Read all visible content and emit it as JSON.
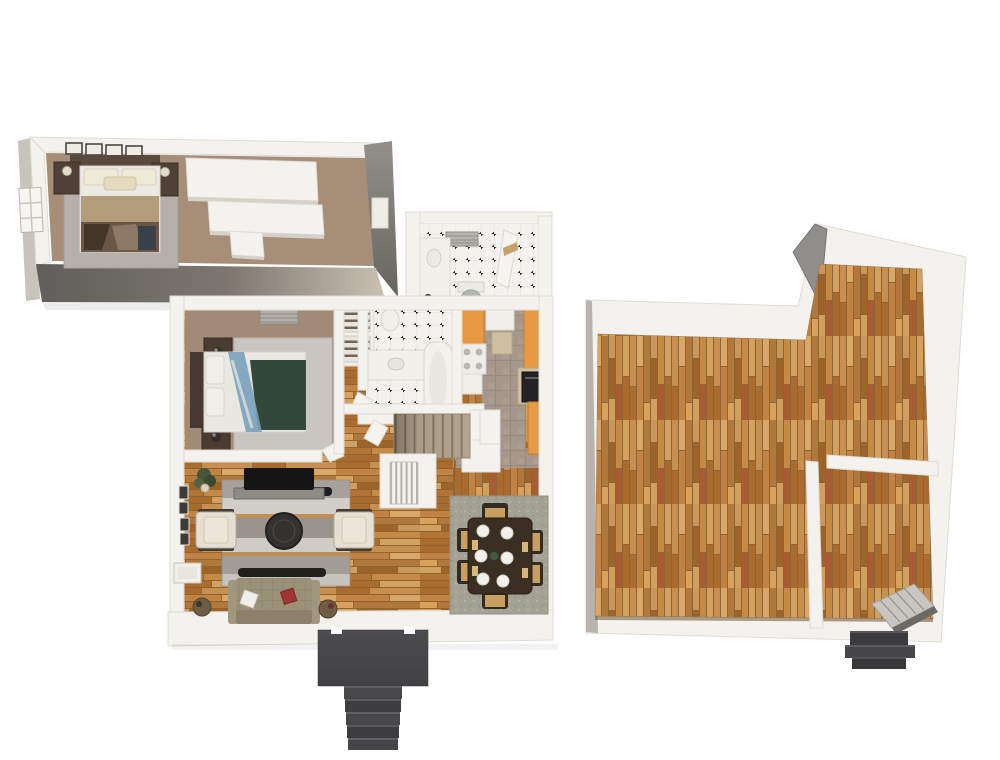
{
  "scene": {
    "type": "3d-floor-plan-render",
    "background": "#ffffff",
    "text_content": "none",
    "palette": {
      "wall_white": "#f4f2ee",
      "wall_edge": "#e0dcd5",
      "front_wall_dark": "#605e5b",
      "front_wall_light": "#cbc1b2",
      "end_wall_gray": "#908e8a",
      "carpet_tan": "#a68e79",
      "carpet_tan2": "#a28b76",
      "rug_gray_bedroom": "#b5b1aa",
      "rug_light": "#c9c6c0",
      "rug_dining": "#a3a295",
      "wood_base": "#c08a4c",
      "kitchen_tile": "#a5978b",
      "tile_white": "#f3f2ee",
      "tile_dot": "#1d1d1d",
      "cabinet_orange": "#e89a43",
      "counter_tan": "#cfc2a6",
      "appliance_black": "#232325",
      "stair_carpet": "#b3a48f",
      "porch_dark": "#454547",
      "sofa_olive": "#9a9179",
      "pillow_red": "#a33434",
      "bed_green": "#31483a",
      "bed_blue": "#7aa0bc",
      "headboard_brown": "#463931",
      "furniture_dark_brown": "#4f4136",
      "table_brown": "#3b2e22",
      "tv_black": "#151515",
      "console_gray": "#8e8a84",
      "chair_cream": "#e6e0d2",
      "cushion_tan": "#c79f5f",
      "plant_green": "#4e5e3a",
      "basement_stair_gray": "#c9c6c1",
      "outside_stair_dark": "#3c3c3e"
    },
    "modules": [
      {
        "name": "upper-floor-bedroom-wing",
        "flooring": "tan carpet",
        "contents": [
          "double bed with tan and patchwork bedding",
          "two dark wood nightstands with lamps",
          "four framed pictures above headboard",
          "grey area rug",
          "window on left wall",
          "white closet partition volumes",
          "dark front and end walls"
        ]
      },
      {
        "name": "main-floor",
        "rooms": [
          {
            "name": "bedroom",
            "flooring": "tan carpet",
            "contents": [
              "double bed with white, blue and dark green bedding",
              "headboard",
              "two nightstands with lamps",
              "light grey area rug",
              "ceiling vent",
              "door"
            ]
          },
          {
            "name": "bathroom",
            "flooring": "white tile with black diamond dots",
            "contents": [
              "toilet",
              "vanity with sink",
              "bathtub",
              "door"
            ]
          },
          {
            "name": "upper-bathroom",
            "flooring": "white tile with black diamond dots",
            "contents": [
              "toilet",
              "vanity counter",
              "ceiling vent",
              "open door"
            ]
          },
          {
            "name": "linen-closet",
            "contents": [
              "two wire shelving units"
            ]
          },
          {
            "name": "kitchen",
            "flooring": "taupe tile",
            "contents": [
              "orange cabinets on both sides",
              "white range with burners",
              "black built-in oven",
              "tan countertops",
              "pantry cabinet"
            ]
          },
          {
            "name": "staircase",
            "contents": [
              "carpeted stairs",
              "white enclosure",
              "railing unit"
            ]
          },
          {
            "name": "living-room",
            "flooring": "hardwood planks",
            "contents": [
              "flat screen TV on grey console",
              "striped grey rug",
              "two dark media benches",
              "round dark coffee table",
              "two cream armchairs",
              "olive tufted sofa with red and white pillows",
              "two round side tables",
              "potted plant",
              "framed wall art",
              "window seat"
            ]
          },
          {
            "name": "dining-room",
            "flooring": "hardwood planks",
            "contents": [
              "dark wood dining table",
              "six chairs with tan cushions",
              "six white place settings",
              "green centerpiece",
              "textured grey-green rug"
            ]
          },
          {
            "name": "entry-porch",
            "contents": [
              "dark grey landing",
              "five exterior steps"
            ]
          }
        ]
      },
      {
        "name": "basement",
        "flooring": "hardwood planks",
        "rooms": [
          {
            "name": "open-recreation-area",
            "contents": [
              "L-shaped open floor",
              "grey wall end cap"
            ]
          },
          {
            "name": "storage-room",
            "contents": [
              "interior partition walls",
              "doorway opening",
              "staircase going down"
            ]
          },
          {
            "name": "exterior-stoop",
            "contents": [
              "three dark steps"
            ]
          }
        ]
      }
    ]
  }
}
